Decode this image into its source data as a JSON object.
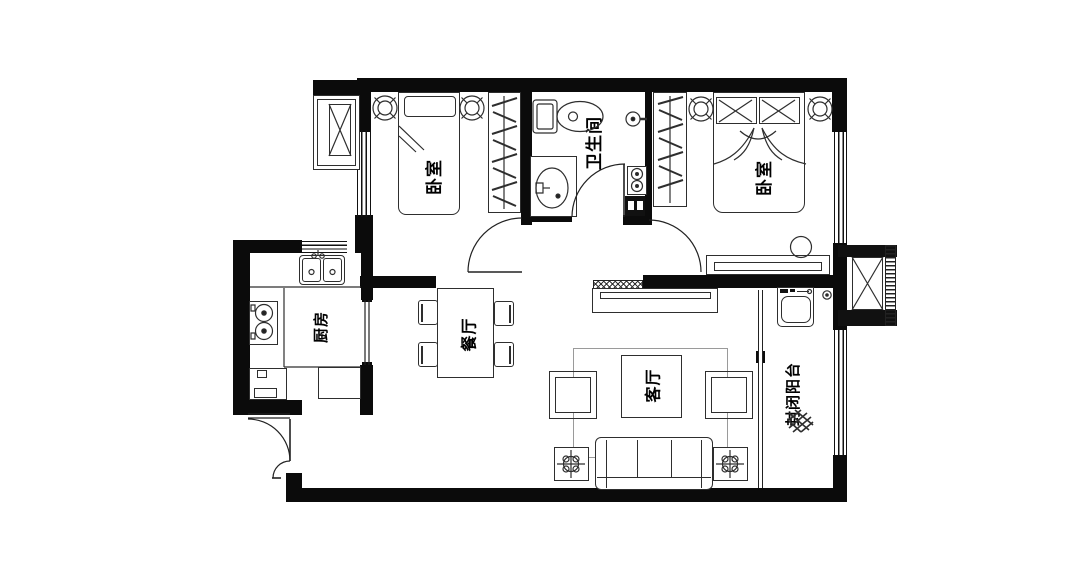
{
  "rooms": {
    "bedroom_left": {
      "label": "卧室"
    },
    "bedroom_right": {
      "label": "卧室"
    },
    "bathroom": {
      "label": "卫生间"
    },
    "kitchen": {
      "label": "厨房"
    },
    "dining": {
      "label": "餐厅"
    },
    "living": {
      "label": "客厅"
    },
    "balcony": {
      "label": "封闭阳台"
    }
  },
  "colors": {
    "wall": "#0b0b0b",
    "line": "#2e2e2e",
    "light_line": "#9a9a9a",
    "background": "#ffffff"
  }
}
